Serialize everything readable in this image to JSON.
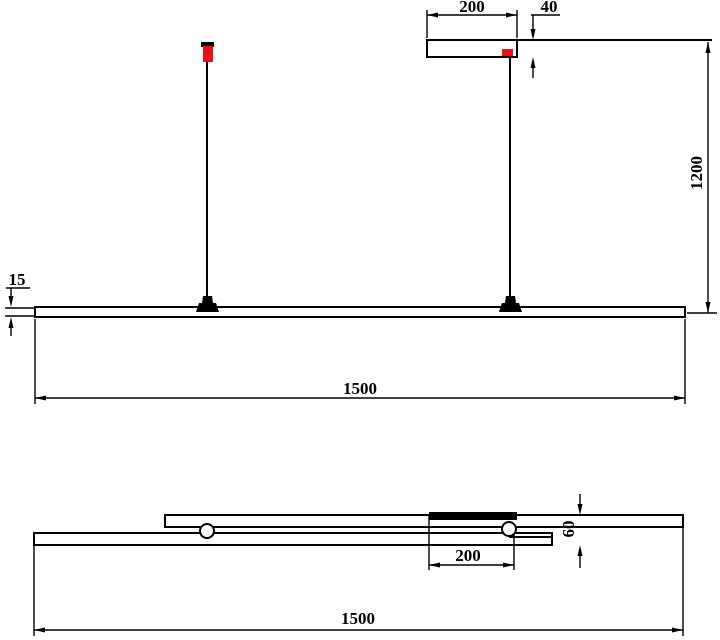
{
  "drawing": {
    "type": "technical-dimension-drawing",
    "subject": "linear-pendant-lamp"
  },
  "colors": {
    "line": "#000000",
    "accent_red": "#e8111a",
    "background": "#ffffff"
  },
  "front_view": {
    "dim_canopy_width": "200",
    "dim_canopy_height": "40",
    "dim_suspension_height": "1200",
    "dim_bar_thickness": "15",
    "dim_overall_length": "1500"
  },
  "plan_view": {
    "dim_canopy_width": "200",
    "dim_stack_depth": "60",
    "dim_overall_length": "1500"
  }
}
